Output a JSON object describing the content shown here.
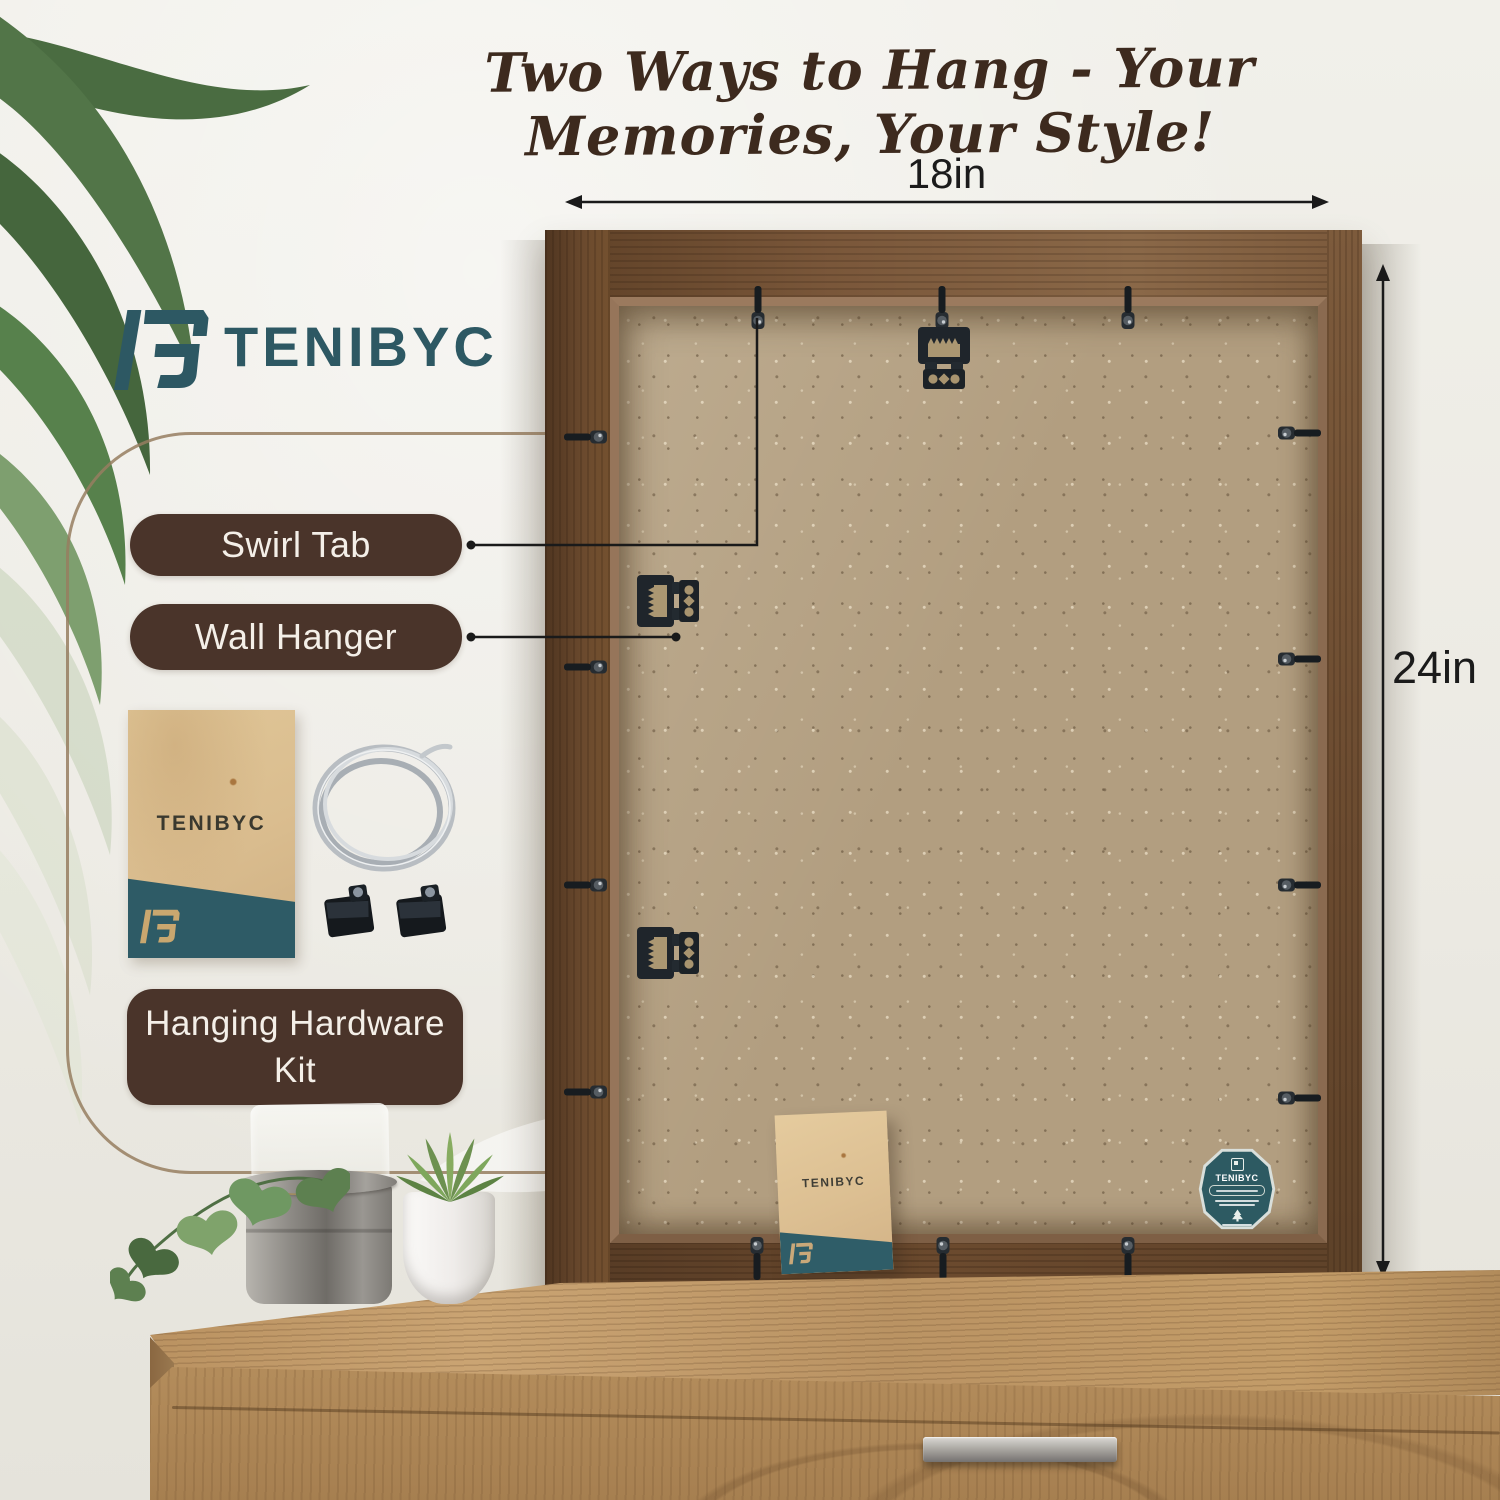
{
  "page": {
    "title": "Two Ways to Hang - Your Memories, Your Style!"
  },
  "brand": {
    "name": "TENIBYC"
  },
  "dimensions": {
    "width_label": "18in",
    "height_label": "24in"
  },
  "callout_labels": {
    "swirl_tab": "Swirl Tab",
    "wall_hanger": "Wall Hanger",
    "hanging_kit": "Hanging Hardware Kit"
  },
  "hardware": {
    "kit_envelope_brand": "TENIBYC",
    "back_envelope_brand": "TENIBYC",
    "badge_brand": "TENIBYC"
  },
  "icons": {
    "logo_mark": "tenibyc-logo-mark",
    "palm": "palm-leaves",
    "wire": "hanging-wire-coil",
    "d_rings": "d-ring-hooks",
    "sawtooth": "sawtooth-wall-hanger",
    "swirl": "swirl-tab",
    "badge": "eco-certification-seal"
  },
  "colors": {
    "teal": "#2d5863",
    "label_brown": "#4a342a",
    "title_brown": "#3d2a1e",
    "wood_frame": "#6b4a2e",
    "kraft_board": "#b29e80",
    "wall": "#eceae3"
  }
}
